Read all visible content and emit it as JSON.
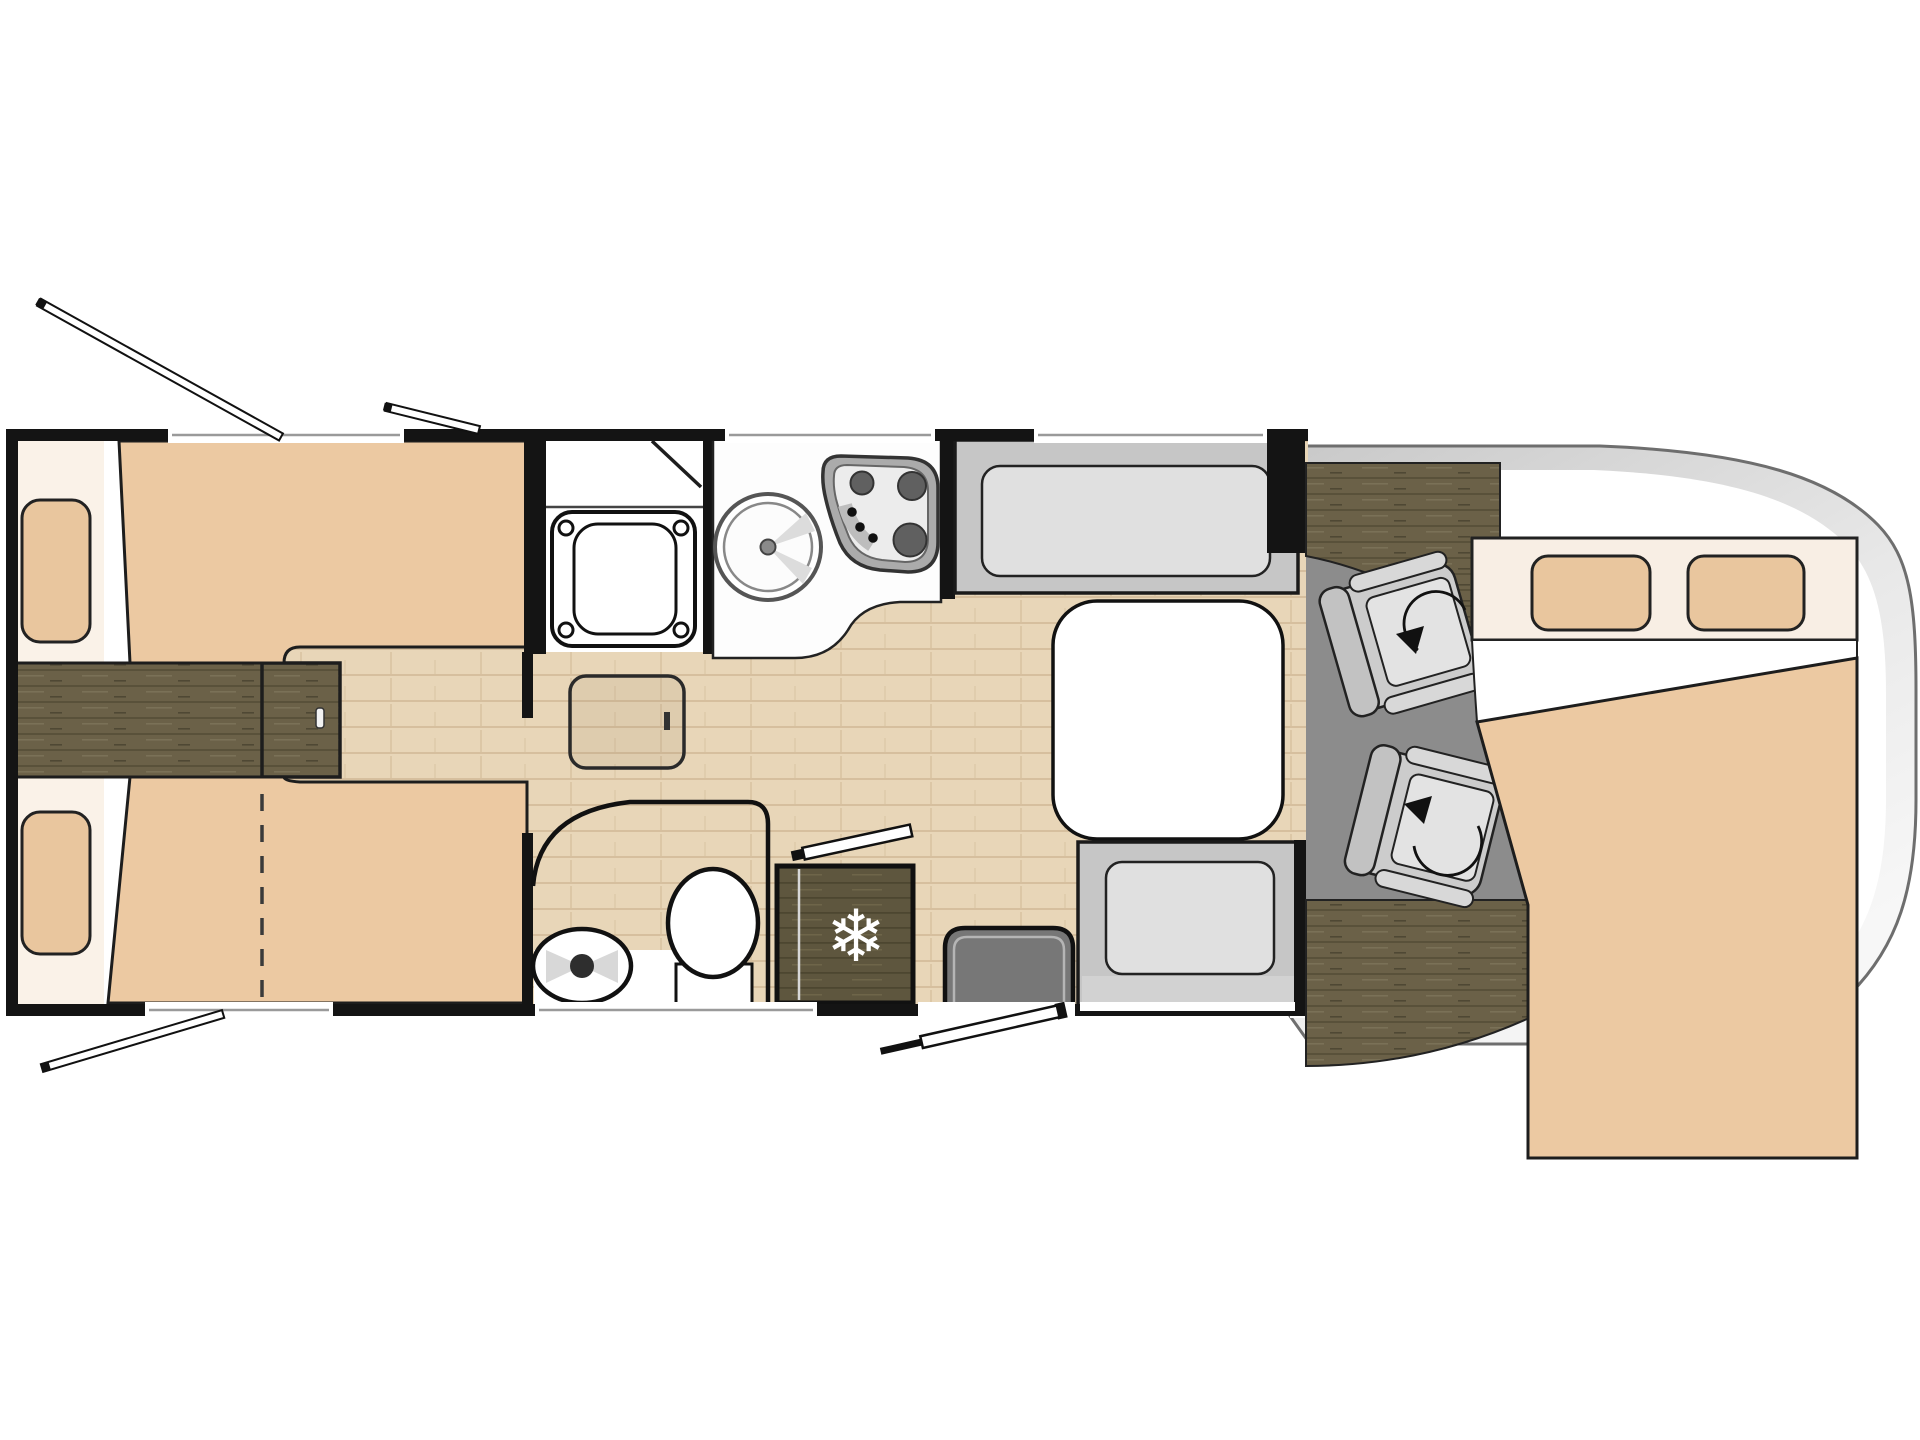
{
  "title": "motorhome-floorplan",
  "icons": {
    "snowflake_glyph": "❄"
  },
  "palette": {
    "wall": "#141414",
    "bed_tan": "#ecc9a2",
    "pillow_tan": "#e9c69e",
    "cream_shelf": "#faf2e8",
    "overcab_head_band": "#f8eee4",
    "floor_wood_light": "#e8d6b8",
    "floor_wood_line": "#d6bf9e",
    "dark_wood": "#6b6148",
    "dark_wood_line": "#59513a",
    "fridge_wood": "#5e563e",
    "cab_floor_gray": "#8c8c8c",
    "bench_gray": "#c6c6c6",
    "seat_light_gray": "#e0e0e0",
    "table_white": "#ffffff",
    "body_band_gray": "#d2d2d2",
    "body_stroke": "#6e6e6e"
  }
}
